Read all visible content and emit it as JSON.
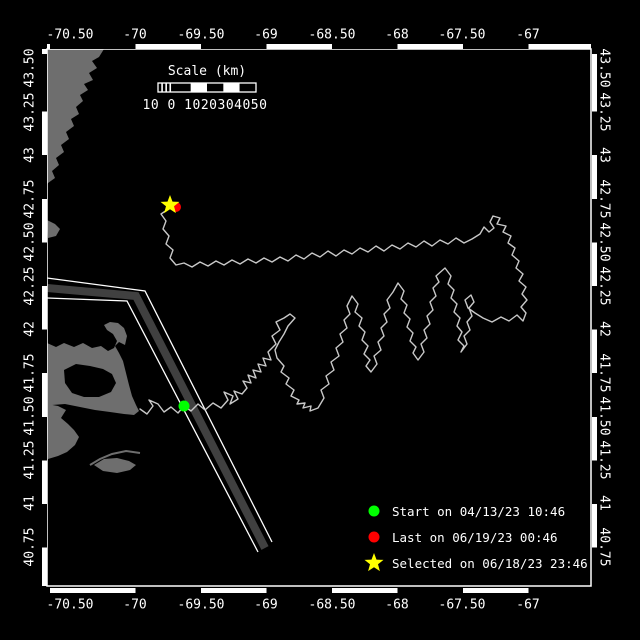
{
  "figure": {
    "width": 640,
    "height": 640,
    "background": "#000000"
  },
  "plot": {
    "x0": 47,
    "y0": 49,
    "x1": 591,
    "y1": 586,
    "frame_color": "#ffffff"
  },
  "axes": {
    "lon_ticks": [
      {
        "label": "-70.50",
        "x": 70
      },
      {
        "label": "-70",
        "x": 135
      },
      {
        "label": "-69.50",
        "x": 201
      },
      {
        "label": "-69",
        "x": 266
      },
      {
        "label": "-68.50",
        "x": 332
      },
      {
        "label": "-68",
        "x": 397
      },
      {
        "label": "-67.50",
        "x": 462
      },
      {
        "label": "-67",
        "x": 528
      }
    ],
    "lat_ticks": [
      {
        "label": "43.50",
        "y": 68
      },
      {
        "label": "43.25",
        "y": 112
      },
      {
        "label": "43",
        "y": 155
      },
      {
        "label": "42.75",
        "y": 199
      },
      {
        "label": "42.50",
        "y": 242
      },
      {
        "label": "42.25",
        "y": 286
      },
      {
        "label": "42",
        "y": 329
      },
      {
        "label": "41.75",
        "y": 373
      },
      {
        "label": "41.50",
        "y": 416
      },
      {
        "label": "41.25",
        "y": 460
      },
      {
        "label": "41",
        "y": 503
      },
      {
        "label": "40.75",
        "y": 547
      }
    ],
    "tick_color": "#ffffff"
  },
  "scalebar": {
    "title": "Scale (km)",
    "labels_text": "10 0 1020304050",
    "x": 158,
    "y": 83,
    "width": 98,
    "height": 9,
    "segments": [
      "hatch",
      "black",
      "white",
      "black",
      "white",
      "black"
    ]
  },
  "legend": {
    "items": [
      {
        "marker": "dot",
        "color": "#00ff00",
        "label": "Start on 04/13/23 10:46"
      },
      {
        "marker": "dot",
        "color": "#ff0000",
        "label": "Last on 06/19/23 00:46"
      },
      {
        "marker": "star",
        "color": "#ffff00",
        "label": "Selected on 06/18/23 23:46"
      }
    ]
  },
  "map": {
    "land_color": "#6e6e6e",
    "water_color": "#000000",
    "lane_band_color": "#404040",
    "lane_edge_color": "#ffffff",
    "track_color": "#c8c8c8",
    "land": [
      {
        "name": "north-shore",
        "points": [
          [
            47,
            49
          ],
          [
            104,
            49
          ],
          [
            99,
            57
          ],
          [
            92,
            61
          ],
          [
            97,
            68
          ],
          [
            89,
            73
          ],
          [
            93,
            80
          ],
          [
            84,
            84
          ],
          [
            88,
            90
          ],
          [
            80,
            95
          ],
          [
            83,
            101
          ],
          [
            76,
            107
          ],
          [
            79,
            114
          ],
          [
            71,
            119
          ],
          [
            74,
            126
          ],
          [
            66,
            132
          ],
          [
            69,
            139
          ],
          [
            61,
            145
          ],
          [
            64,
            152
          ],
          [
            56,
            158
          ],
          [
            59,
            165
          ],
          [
            52,
            171
          ],
          [
            55,
            178
          ],
          [
            48,
            183
          ],
          [
            47,
            185
          ]
        ]
      },
      {
        "name": "coast-blob",
        "points": [
          [
            47,
            220
          ],
          [
            55,
            224
          ],
          [
            60,
            229
          ],
          [
            56,
            236
          ],
          [
            48,
            238
          ]
        ]
      },
      {
        "name": "cape-cod",
        "points": [
          [
            47,
            343
          ],
          [
            56,
            347
          ],
          [
            64,
            343
          ],
          [
            74,
            347
          ],
          [
            83,
            343
          ],
          [
            92,
            348
          ],
          [
            101,
            346
          ],
          [
            108,
            351
          ],
          [
            114,
            348
          ],
          [
            117,
            341
          ],
          [
            113,
            334
          ],
          [
            107,
            330
          ],
          [
            104,
            325
          ],
          [
            110,
            322
          ],
          [
            118,
            323
          ],
          [
            124,
            328
          ],
          [
            127,
            336
          ],
          [
            125,
            345
          ],
          [
            119,
            342
          ],
          [
            115,
            346
          ],
          [
            119,
            353
          ],
          [
            123,
            361
          ],
          [
            126,
            373
          ],
          [
            129,
            385
          ],
          [
            132,
            396
          ],
          [
            136,
            405
          ],
          [
            139,
            411
          ],
          [
            134,
            415
          ],
          [
            124,
            414
          ],
          [
            110,
            412
          ],
          [
            95,
            410
          ],
          [
            80,
            407
          ],
          [
            65,
            404
          ],
          [
            52,
            405
          ],
          [
            47,
            407
          ]
        ]
      },
      {
        "name": "south-strip-marthas-vineyard",
        "points": [
          [
            47,
            404
          ],
          [
            58,
            406
          ],
          [
            66,
            410
          ],
          [
            61,
            418
          ],
          [
            68,
            424
          ],
          [
            74,
            430
          ],
          [
            79,
            437
          ],
          [
            75,
            445
          ],
          [
            67,
            452
          ],
          [
            58,
            456
          ],
          [
            48,
            459
          ]
        ]
      },
      {
        "name": "nantucket",
        "points": [
          [
            94,
            465
          ],
          [
            104,
            459
          ],
          [
            117,
            458
          ],
          [
            129,
            461
          ],
          [
            136,
            465
          ],
          [
            130,
            470
          ],
          [
            117,
            473
          ],
          [
            103,
            471
          ]
        ]
      }
    ],
    "water_holes": [
      {
        "name": "cape-cod-bay",
        "points": [
          [
            64,
            370
          ],
          [
            76,
            364
          ],
          [
            90,
            366
          ],
          [
            103,
            369
          ],
          [
            112,
            374
          ],
          [
            116,
            383
          ],
          [
            111,
            392
          ],
          [
            99,
            397
          ],
          [
            84,
            397
          ],
          [
            72,
            393
          ],
          [
            65,
            383
          ]
        ]
      }
    ],
    "coast_lines": [
      {
        "name": "coatue-spit",
        "points": [
          [
            90,
            465
          ],
          [
            100,
            459
          ],
          [
            112,
            454
          ],
          [
            126,
            451
          ],
          [
            140,
            453
          ]
        ]
      }
    ],
    "lanes": {
      "band": [
        [
          47,
          288
        ],
        [
          136,
          296
        ],
        [
          265,
          548
        ]
      ],
      "edge_ne": [
        [
          47,
          278
        ],
        [
          145,
          291
        ],
        [
          272,
          542
        ]
      ],
      "edge_sw": [
        [
          47,
          298
        ],
        [
          127,
          301
        ],
        [
          258,
          552
        ]
      ]
    },
    "track": [
      [
        140,
        409
      ],
      [
        147,
        414
      ],
      [
        153,
        406
      ],
      [
        149,
        400
      ],
      [
        158,
        404
      ],
      [
        164,
        412
      ],
      [
        171,
        407
      ],
      [
        178,
        413
      ],
      [
        184,
        406
      ],
      [
        191,
        411
      ],
      [
        198,
        404
      ],
      [
        205,
        410
      ],
      [
        213,
        403
      ],
      [
        221,
        408
      ],
      [
        228,
        400
      ],
      [
        224,
        392
      ],
      [
        233,
        396
      ],
      [
        230,
        404
      ],
      [
        238,
        399
      ],
      [
        234,
        391
      ],
      [
        242,
        394
      ],
      [
        247,
        388
      ],
      [
        243,
        381
      ],
      [
        251,
        383
      ],
      [
        248,
        375
      ],
      [
        256,
        378
      ],
      [
        253,
        370
      ],
      [
        261,
        372
      ],
      [
        258,
        364
      ],
      [
        266,
        366
      ],
      [
        263,
        358
      ],
      [
        271,
        360
      ],
      [
        268,
        352
      ],
      [
        276,
        344
      ],
      [
        272,
        336
      ],
      [
        280,
        330
      ],
      [
        276,
        322
      ],
      [
        284,
        318
      ],
      [
        290,
        314
      ],
      [
        295,
        318
      ],
      [
        288,
        326
      ],
      [
        284,
        334
      ],
      [
        279,
        342
      ],
      [
        275,
        350
      ],
      [
        277,
        358
      ],
      [
        284,
        366
      ],
      [
        281,
        372
      ],
      [
        289,
        378
      ],
      [
        286,
        384
      ],
      [
        294,
        390
      ],
      [
        291,
        396
      ],
      [
        299,
        400
      ],
      [
        297,
        404
      ],
      [
        305,
        403
      ],
      [
        303,
        408
      ],
      [
        311,
        406
      ],
      [
        310,
        411
      ],
      [
        318,
        408
      ],
      [
        324,
        398
      ],
      [
        321,
        390
      ],
      [
        329,
        384
      ],
      [
        326,
        376
      ],
      [
        334,
        370
      ],
      [
        331,
        362
      ],
      [
        339,
        356
      ],
      [
        336,
        348
      ],
      [
        343,
        342
      ],
      [
        340,
        334
      ],
      [
        347,
        328
      ],
      [
        344,
        320
      ],
      [
        350,
        314
      ],
      [
        347,
        306
      ],
      [
        352,
        296
      ],
      [
        358,
        304
      ],
      [
        355,
        312
      ],
      [
        362,
        318
      ],
      [
        359,
        326
      ],
      [
        365,
        332
      ],
      [
        362,
        340
      ],
      [
        368,
        346
      ],
      [
        364,
        354
      ],
      [
        370,
        360
      ],
      [
        366,
        366
      ],
      [
        371,
        372
      ],
      [
        377,
        364
      ],
      [
        374,
        356
      ],
      [
        381,
        350
      ],
      [
        378,
        342
      ],
      [
        384,
        336
      ],
      [
        381,
        328
      ],
      [
        387,
        322
      ],
      [
        384,
        314
      ],
      [
        390,
        308
      ],
      [
        387,
        300
      ],
      [
        393,
        292
      ],
      [
        398,
        283
      ],
      [
        404,
        291
      ],
      [
        401,
        299
      ],
      [
        407,
        305
      ],
      [
        404,
        313
      ],
      [
        410,
        319
      ],
      [
        407,
        327
      ],
      [
        413,
        333
      ],
      [
        410,
        341
      ],
      [
        416,
        347
      ],
      [
        413,
        353
      ],
      [
        418,
        360
      ],
      [
        424,
        352
      ],
      [
        421,
        344
      ],
      [
        427,
        338
      ],
      [
        424,
        330
      ],
      [
        430,
        324
      ],
      [
        427,
        316
      ],
      [
        433,
        310
      ],
      [
        430,
        302
      ],
      [
        436,
        296
      ],
      [
        433,
        288
      ],
      [
        439,
        282
      ],
      [
        436,
        276
      ],
      [
        445,
        268
      ],
      [
        451,
        276
      ],
      [
        448,
        284
      ],
      [
        454,
        290
      ],
      [
        451,
        298
      ],
      [
        457,
        304
      ],
      [
        454,
        312
      ],
      [
        460,
        318
      ],
      [
        457,
        326
      ],
      [
        462,
        332
      ],
      [
        458,
        340
      ],
      [
        464,
        346
      ],
      [
        461,
        352
      ],
      [
        467,
        344
      ],
      [
        464,
        336
      ],
      [
        470,
        330
      ],
      [
        467,
        322
      ],
      [
        472,
        316
      ],
      [
        469,
        308
      ],
      [
        474,
        302
      ],
      [
        471,
        295
      ],
      [
        465,
        300
      ],
      [
        468,
        308
      ],
      [
        475,
        313
      ],
      [
        483,
        318
      ],
      [
        492,
        322
      ],
      [
        501,
        317
      ],
      [
        509,
        321
      ],
      [
        517,
        315
      ],
      [
        523,
        321
      ],
      [
        526,
        313
      ],
      [
        521,
        307
      ],
      [
        527,
        300
      ],
      [
        522,
        294
      ],
      [
        526,
        287
      ],
      [
        519,
        281
      ],
      [
        523,
        274
      ],
      [
        516,
        268
      ],
      [
        519,
        261
      ],
      [
        512,
        255
      ],
      [
        515,
        248
      ],
      [
        508,
        243
      ],
      [
        511,
        236
      ],
      [
        503,
        232
      ],
      [
        506,
        226
      ],
      [
        497,
        224
      ],
      [
        500,
        218
      ],
      [
        493,
        216
      ],
      [
        490,
        222
      ],
      [
        494,
        228
      ],
      [
        489,
        232
      ],
      [
        484,
        227
      ],
      [
        480,
        234
      ],
      [
        472,
        239
      ],
      [
        464,
        243
      ],
      [
        456,
        238
      ],
      [
        448,
        244
      ],
      [
        440,
        240
      ],
      [
        432,
        246
      ],
      [
        424,
        241
      ],
      [
        416,
        247
      ],
      [
        408,
        243
      ],
      [
        400,
        249
      ],
      [
        392,
        245
      ],
      [
        384,
        251
      ],
      [
        376,
        246
      ],
      [
        368,
        252
      ],
      [
        360,
        248
      ],
      [
        352,
        254
      ],
      [
        344,
        250
      ],
      [
        336,
        256
      ],
      [
        328,
        251
      ],
      [
        320,
        257
      ],
      [
        312,
        253
      ],
      [
        304,
        259
      ],
      [
        296,
        255
      ],
      [
        288,
        261
      ],
      [
        280,
        257
      ],
      [
        272,
        262
      ],
      [
        264,
        258
      ],
      [
        256,
        263
      ],
      [
        248,
        259
      ],
      [
        240,
        264
      ],
      [
        232,
        260
      ],
      [
        224,
        265
      ],
      [
        216,
        261
      ],
      [
        208,
        266
      ],
      [
        200,
        262
      ],
      [
        192,
        267
      ],
      [
        184,
        263
      ],
      [
        176,
        265
      ],
      [
        170,
        258
      ],
      [
        173,
        250
      ],
      [
        166,
        244
      ],
      [
        169,
        236
      ],
      [
        163,
        229
      ],
      [
        166,
        221
      ],
      [
        161,
        214
      ],
      [
        167,
        210
      ],
      [
        170,
        206
      ]
    ],
    "markers": {
      "start": {
        "x": 184,
        "y": 406,
        "color": "#00ff00",
        "shape": "dot"
      },
      "last": {
        "x": 176,
        "y": 207,
        "color": "#ff0000",
        "shape": "dot"
      },
      "selected": {
        "x": 170,
        "y": 205,
        "color": "#ffff00",
        "shape": "star"
      }
    }
  }
}
